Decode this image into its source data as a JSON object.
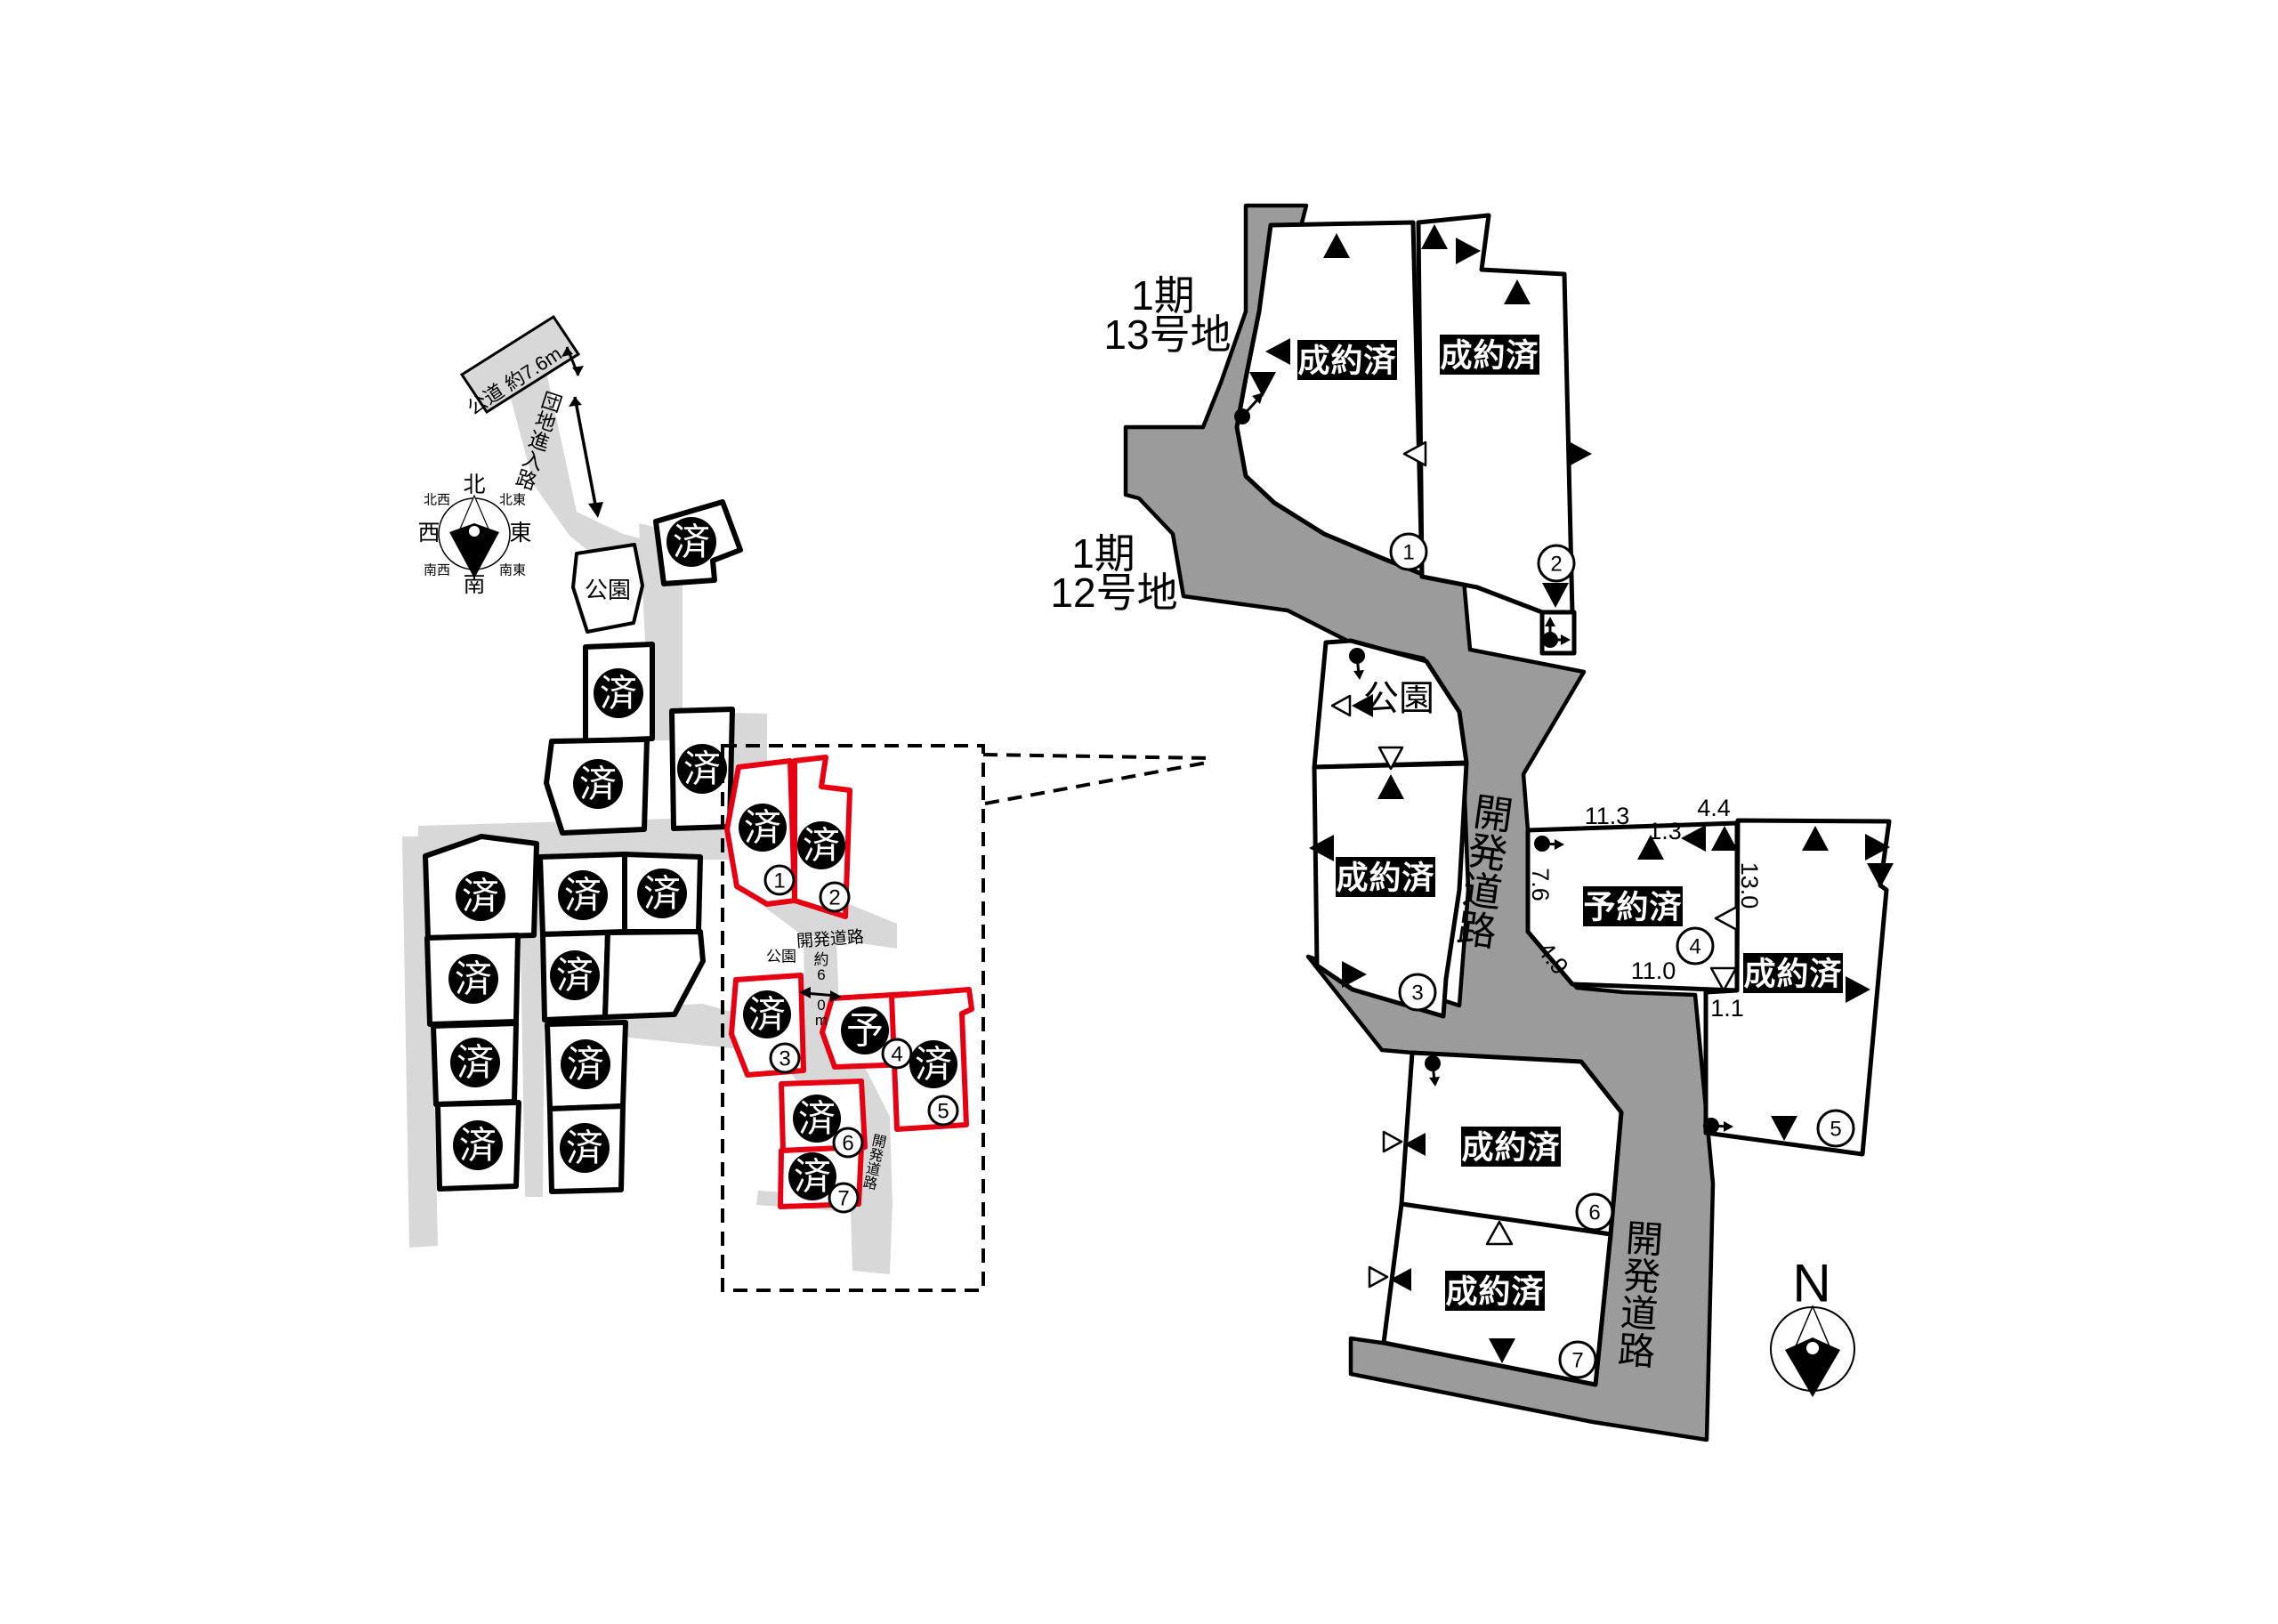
{
  "colors": {
    "available_outline": "#e60012",
    "road_overview": "#d8d8d8",
    "road_detail": "#9b9b9b",
    "badge_bg": "#000000",
    "badge_text": "#ffffff"
  },
  "marks": {
    "sold": "済",
    "reserved": "予"
  },
  "overview": {
    "public_road": "公道 約7.6m",
    "entry_road": "団地進入路",
    "park": "公園",
    "park_small": "公園",
    "dev_road_h": "開発道路",
    "dev_road_v": "開発道路",
    "road_width": "約6.0m",
    "compass": {
      "n": "北",
      "ne": "北東",
      "e": "東",
      "se": "南東",
      "s": "南",
      "sw": "南西",
      "w": "西",
      "nw": "北西"
    },
    "numbered_lots": [
      {
        "no": "1",
        "mark": "済"
      },
      {
        "no": "2",
        "mark": "済"
      },
      {
        "no": "3",
        "mark": "済"
      },
      {
        "no": "4",
        "mark": "予"
      },
      {
        "no": "5",
        "mark": "済"
      },
      {
        "no": "6",
        "mark": "済"
      },
      {
        "no": "7",
        "mark": "済"
      }
    ]
  },
  "detail": {
    "block_label_1": {
      "line1": "1期",
      "line2": "13号地"
    },
    "block_label_2": {
      "line1": "1期",
      "line2": "12号地"
    },
    "park": "公園",
    "dev_road_1": "開発道路",
    "dev_road_2": "開発道路",
    "north": "N",
    "lots": [
      {
        "no": "1",
        "status": "成約済"
      },
      {
        "no": "2",
        "status": "成約済"
      },
      {
        "no": "3",
        "status": "成約済"
      },
      {
        "no": "4",
        "status": "予約済"
      },
      {
        "no": "5",
        "status": "成約済"
      },
      {
        "no": "6",
        "status": "成約済"
      },
      {
        "no": "7",
        "status": "成約済"
      }
    ],
    "measurements": {
      "top_w": "11.3",
      "top_step": "1.3",
      "top_r": "4.4",
      "left_h": "7.6",
      "diag": "4.9",
      "bottom_w": "11.0",
      "divider_h": "13.0",
      "gap": "1.1"
    }
  }
}
